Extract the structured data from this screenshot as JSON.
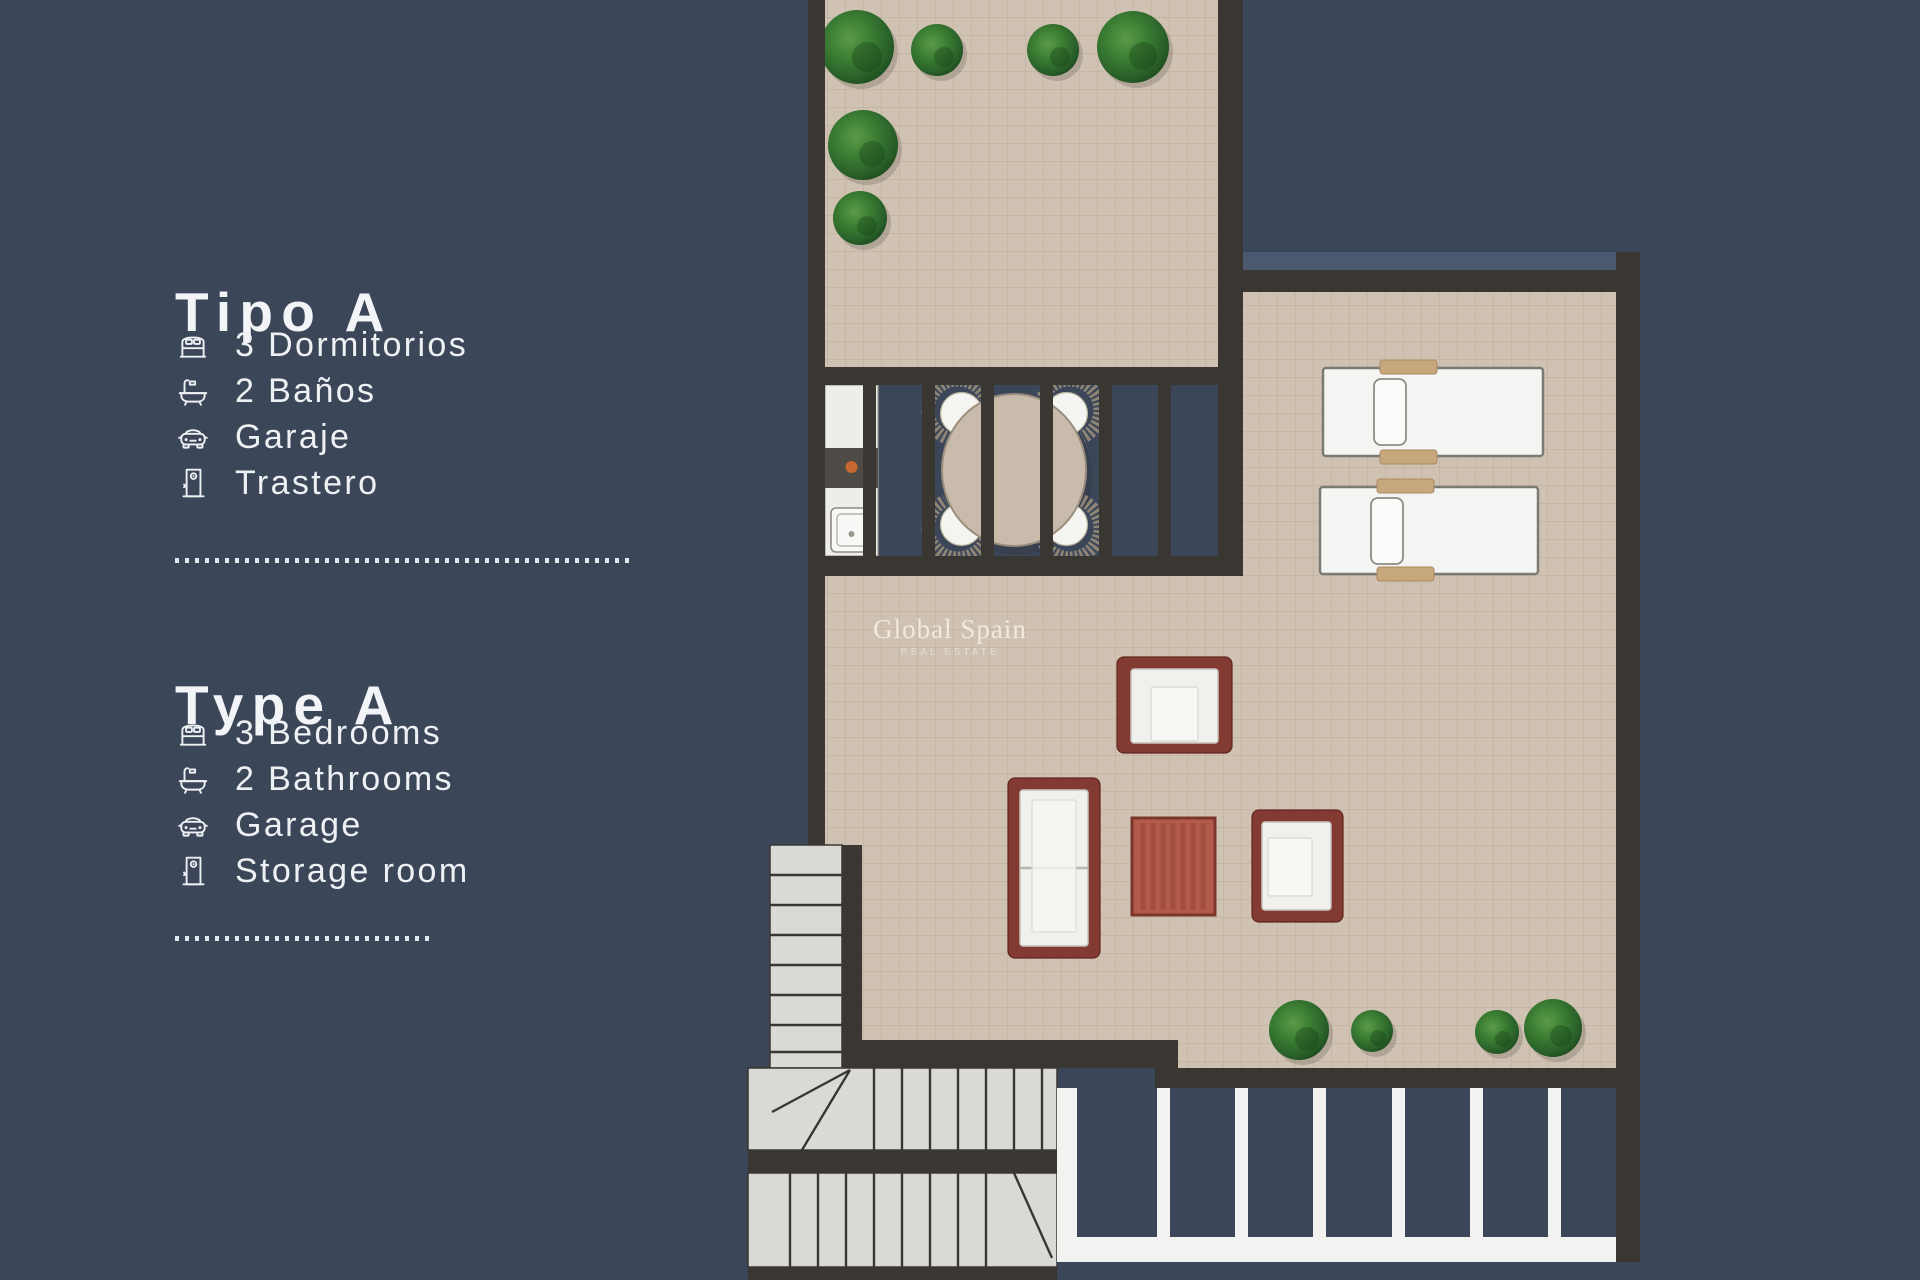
{
  "page": {
    "kind": "real-estate floor plan brochure"
  },
  "panel": {
    "sections": [
      {
        "title": "Tipo A",
        "items": [
          {
            "icon": "bed",
            "label": "3 Dormitorios"
          },
          {
            "icon": "bath",
            "label": "2 Baños"
          },
          {
            "icon": "car",
            "label": "Garaje"
          },
          {
            "icon": "door",
            "label": "Trastero"
          }
        ]
      },
      {
        "title": "Type A",
        "items": [
          {
            "icon": "bed",
            "label": "3 Bedrooms"
          },
          {
            "icon": "bath",
            "label": "2 Bathrooms"
          },
          {
            "icon": "car",
            "label": "Garage"
          },
          {
            "icon": "door",
            "label": "Storage room"
          }
        ]
      }
    ]
  },
  "watermark": {
    "line1": "Global Spain",
    "line2": "REAL ESTATE"
  },
  "colors": {
    "background": "#3C4659",
    "wall": "#3A3733",
    "tile": "#D0C2B2",
    "tile_grid": "#A8937D",
    "white": "#F2F3F0",
    "stairs": "#D9DAD6",
    "light_band": "#4A5870",
    "maroon": "#823A32",
    "terracotta": "#B25B4A",
    "wood": "#C7A87D",
    "counter_dark": "#4E4B47",
    "knob_orange": "#C8672F",
    "text": "#F2F4F7"
  }
}
